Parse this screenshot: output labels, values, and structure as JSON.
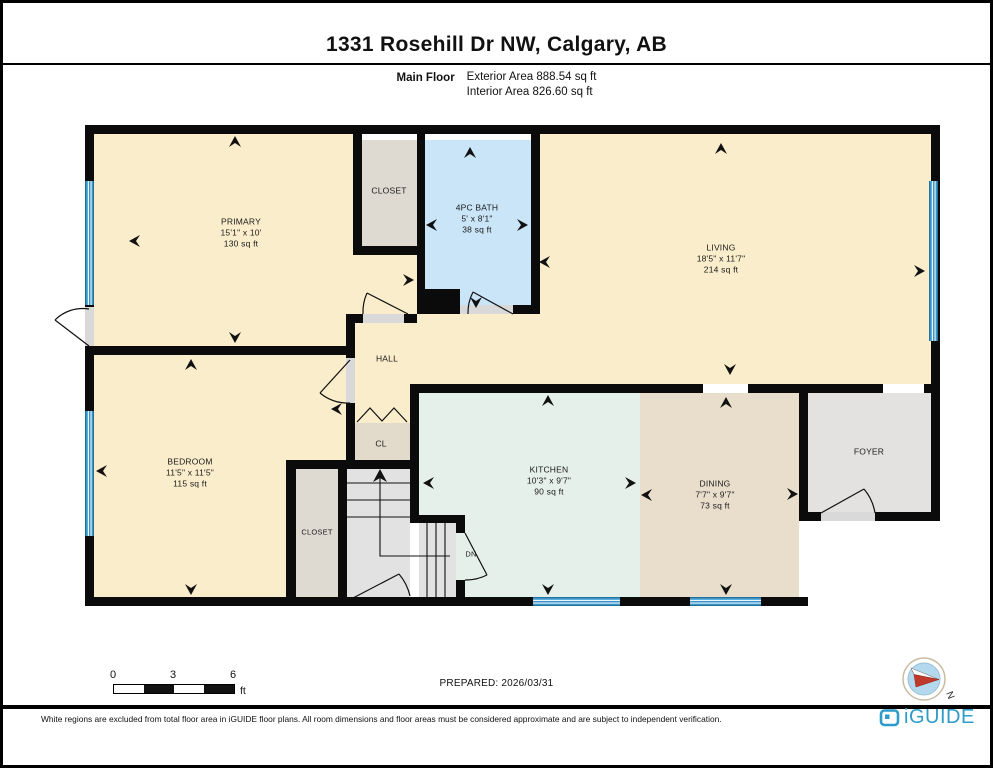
{
  "page": {
    "title": "1331 Rosehill Dr NW, Calgary, AB"
  },
  "header": {
    "floor_label": "Main Floor",
    "exterior_area": "Exterior Area 888.54 sq ft",
    "interior_area": "Interior Area 826.60 sq ft"
  },
  "rooms": {
    "primary": {
      "name": "PRIMARY",
      "dims": "15'1\" x 10'",
      "area": "130 sq ft"
    },
    "closet_top": {
      "name": "CLOSET"
    },
    "bath": {
      "name": "4PC BATH",
      "dims": "5' x 8'1\"",
      "area": "38 sq ft"
    },
    "living": {
      "name": "LIVING",
      "dims": "18'5\" x 11'7\"",
      "area": "214 sq ft"
    },
    "hall": {
      "name": "HALL"
    },
    "cl": {
      "name": "CL"
    },
    "bedroom": {
      "name": "BEDROOM",
      "dims": "11'5\" x 11'5\"",
      "area": "115 sq ft"
    },
    "closet_bedroom": {
      "name": "CLOSET"
    },
    "kitchen": {
      "name": "KITCHEN",
      "dims": "10'3\" x 9'7\"",
      "area": "90 sq ft"
    },
    "dining": {
      "name": "DINING",
      "dims": "7'7\" x 9'7\"",
      "area": "73 sq ft"
    },
    "foyer": {
      "name": "FOYER"
    },
    "stairs": {
      "dn": "DN"
    }
  },
  "footer": {
    "scale": {
      "zero": "0",
      "three": "3",
      "six": "6",
      "unit": "ft"
    },
    "prepared": "PREPARED: 2026/03/31",
    "compass": "N",
    "disclaimer": "White regions are excluded from total floor area in iGUIDE floor plans. All room dimensions and floor areas must be considered approximate and are subject to independent verification.",
    "brand": "iGUIDE"
  },
  "colors": {
    "wall": "#0b0b0b",
    "room_cream": "#FAEDCB",
    "bath_blue": "#C9E5F7",
    "kitchen_mint": "#E6F0EA",
    "dining_tan": "#E9DECC",
    "closet_grey": "#DEDAD2",
    "cl_tan": "#E2DACB",
    "foyer_grey": "#E3E2E0",
    "stairs_grey": "#E2E2E2",
    "window_blue": "#4BA6D9",
    "brand_blue": "#2E9CC9",
    "compass_red": "#C03A2B"
  }
}
